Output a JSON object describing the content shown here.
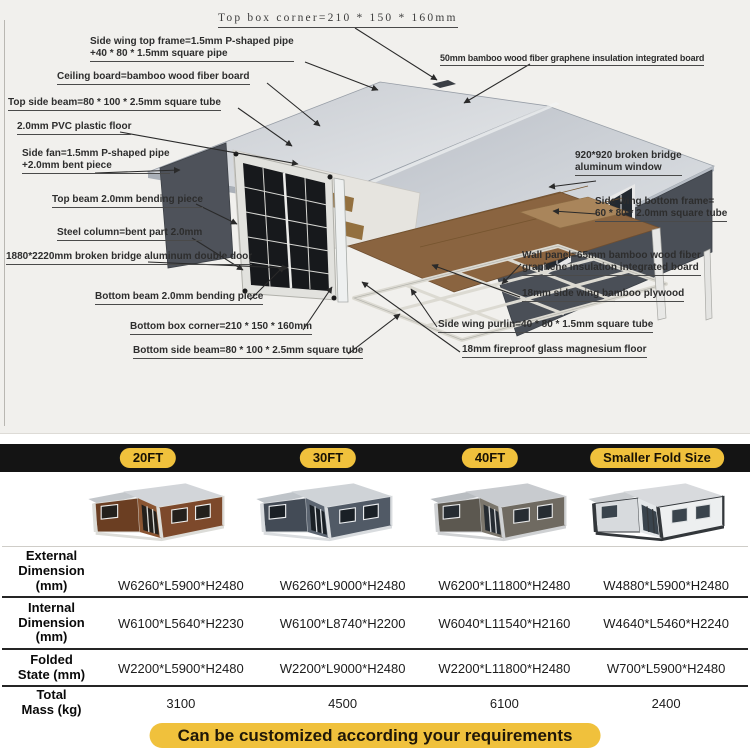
{
  "diagram": {
    "labels": [
      {
        "text": "Top box corner=210 * 150 * 160mm"
      },
      {
        "text": "Side wing top frame=1.5mm P-shaped pipe\n+40 * 80 * 1.5mm square pipe"
      },
      {
        "text": "Ceiling board=bamboo wood fiber board"
      },
      {
        "text": "Top side beam=80 * 100 * 2.5mm square tube"
      },
      {
        "text": "2.0mm PVC plastic floor"
      },
      {
        "text": "Side fan=1.5mm P-shaped pipe\n+2.0mm bent piece"
      },
      {
        "text": "Top beam 2.0mm bending piece"
      },
      {
        "text": "Steel column=bent part 2.0mm"
      },
      {
        "text": "1880*2220mm broken bridge aluminum double door"
      },
      {
        "text": "Bottom beam 2.0mm bending piece"
      },
      {
        "text": "Bottom box corner=210 * 150 * 160mm"
      },
      {
        "text": "Bottom side beam=80 * 100 * 2.5mm square tube"
      },
      {
        "text": "50mm bamboo wood fiber graphene insulation integrated board"
      },
      {
        "text": "920*920 broken bridge\naluminum window"
      },
      {
        "text": "Side wing bottom frame=\n60 * 80 * 2.0mm square tube"
      },
      {
        "text": "Wall panel=65mm bamboo wood fiber\ngraphene insulation integrated board"
      },
      {
        "text": "18mm side wing bamboo plywood"
      },
      {
        "text": "Side wing purlin=40 * 80 * 1.5mm square tube"
      },
      {
        "text": "18mm fireproof glass magnesium floor"
      }
    ]
  },
  "table": {
    "tabs": [
      {
        "label": "20FT"
      },
      {
        "label": "30FT"
      },
      {
        "label": "40FT"
      },
      {
        "label": "Smaller Fold Size"
      }
    ],
    "rows": [
      {
        "label": "External\nDimension\n(mm)",
        "values": [
          "W6260*L5900*H2480",
          "W6260*L9000*H2480",
          "W6200*L11800*H2480",
          "W4880*L5900*H2480"
        ]
      },
      {
        "label": "Internal\nDimension\n(mm)",
        "values": [
          "W6100*L5640*H2230",
          "W6100*L8740*H2200",
          "W6040*L11540*H2160",
          "W4640*L5460*H2240"
        ]
      },
      {
        "label": "Folded\nState (mm)",
        "values": [
          "W2200*L5900*H2480",
          "W2200*L9000*H2480",
          "W2200*L11800*H2480",
          "W700*L5900*H2480"
        ]
      },
      {
        "label": "Total\nMass (kg)",
        "values": [
          "3100",
          "4500",
          "6100",
          "2400"
        ]
      }
    ],
    "banner": "Can be customized according your requirements"
  },
  "colors": {
    "accent_yellow": "#F0C13C",
    "bar_black": "#141414",
    "banner_text": "#1F1708"
  }
}
